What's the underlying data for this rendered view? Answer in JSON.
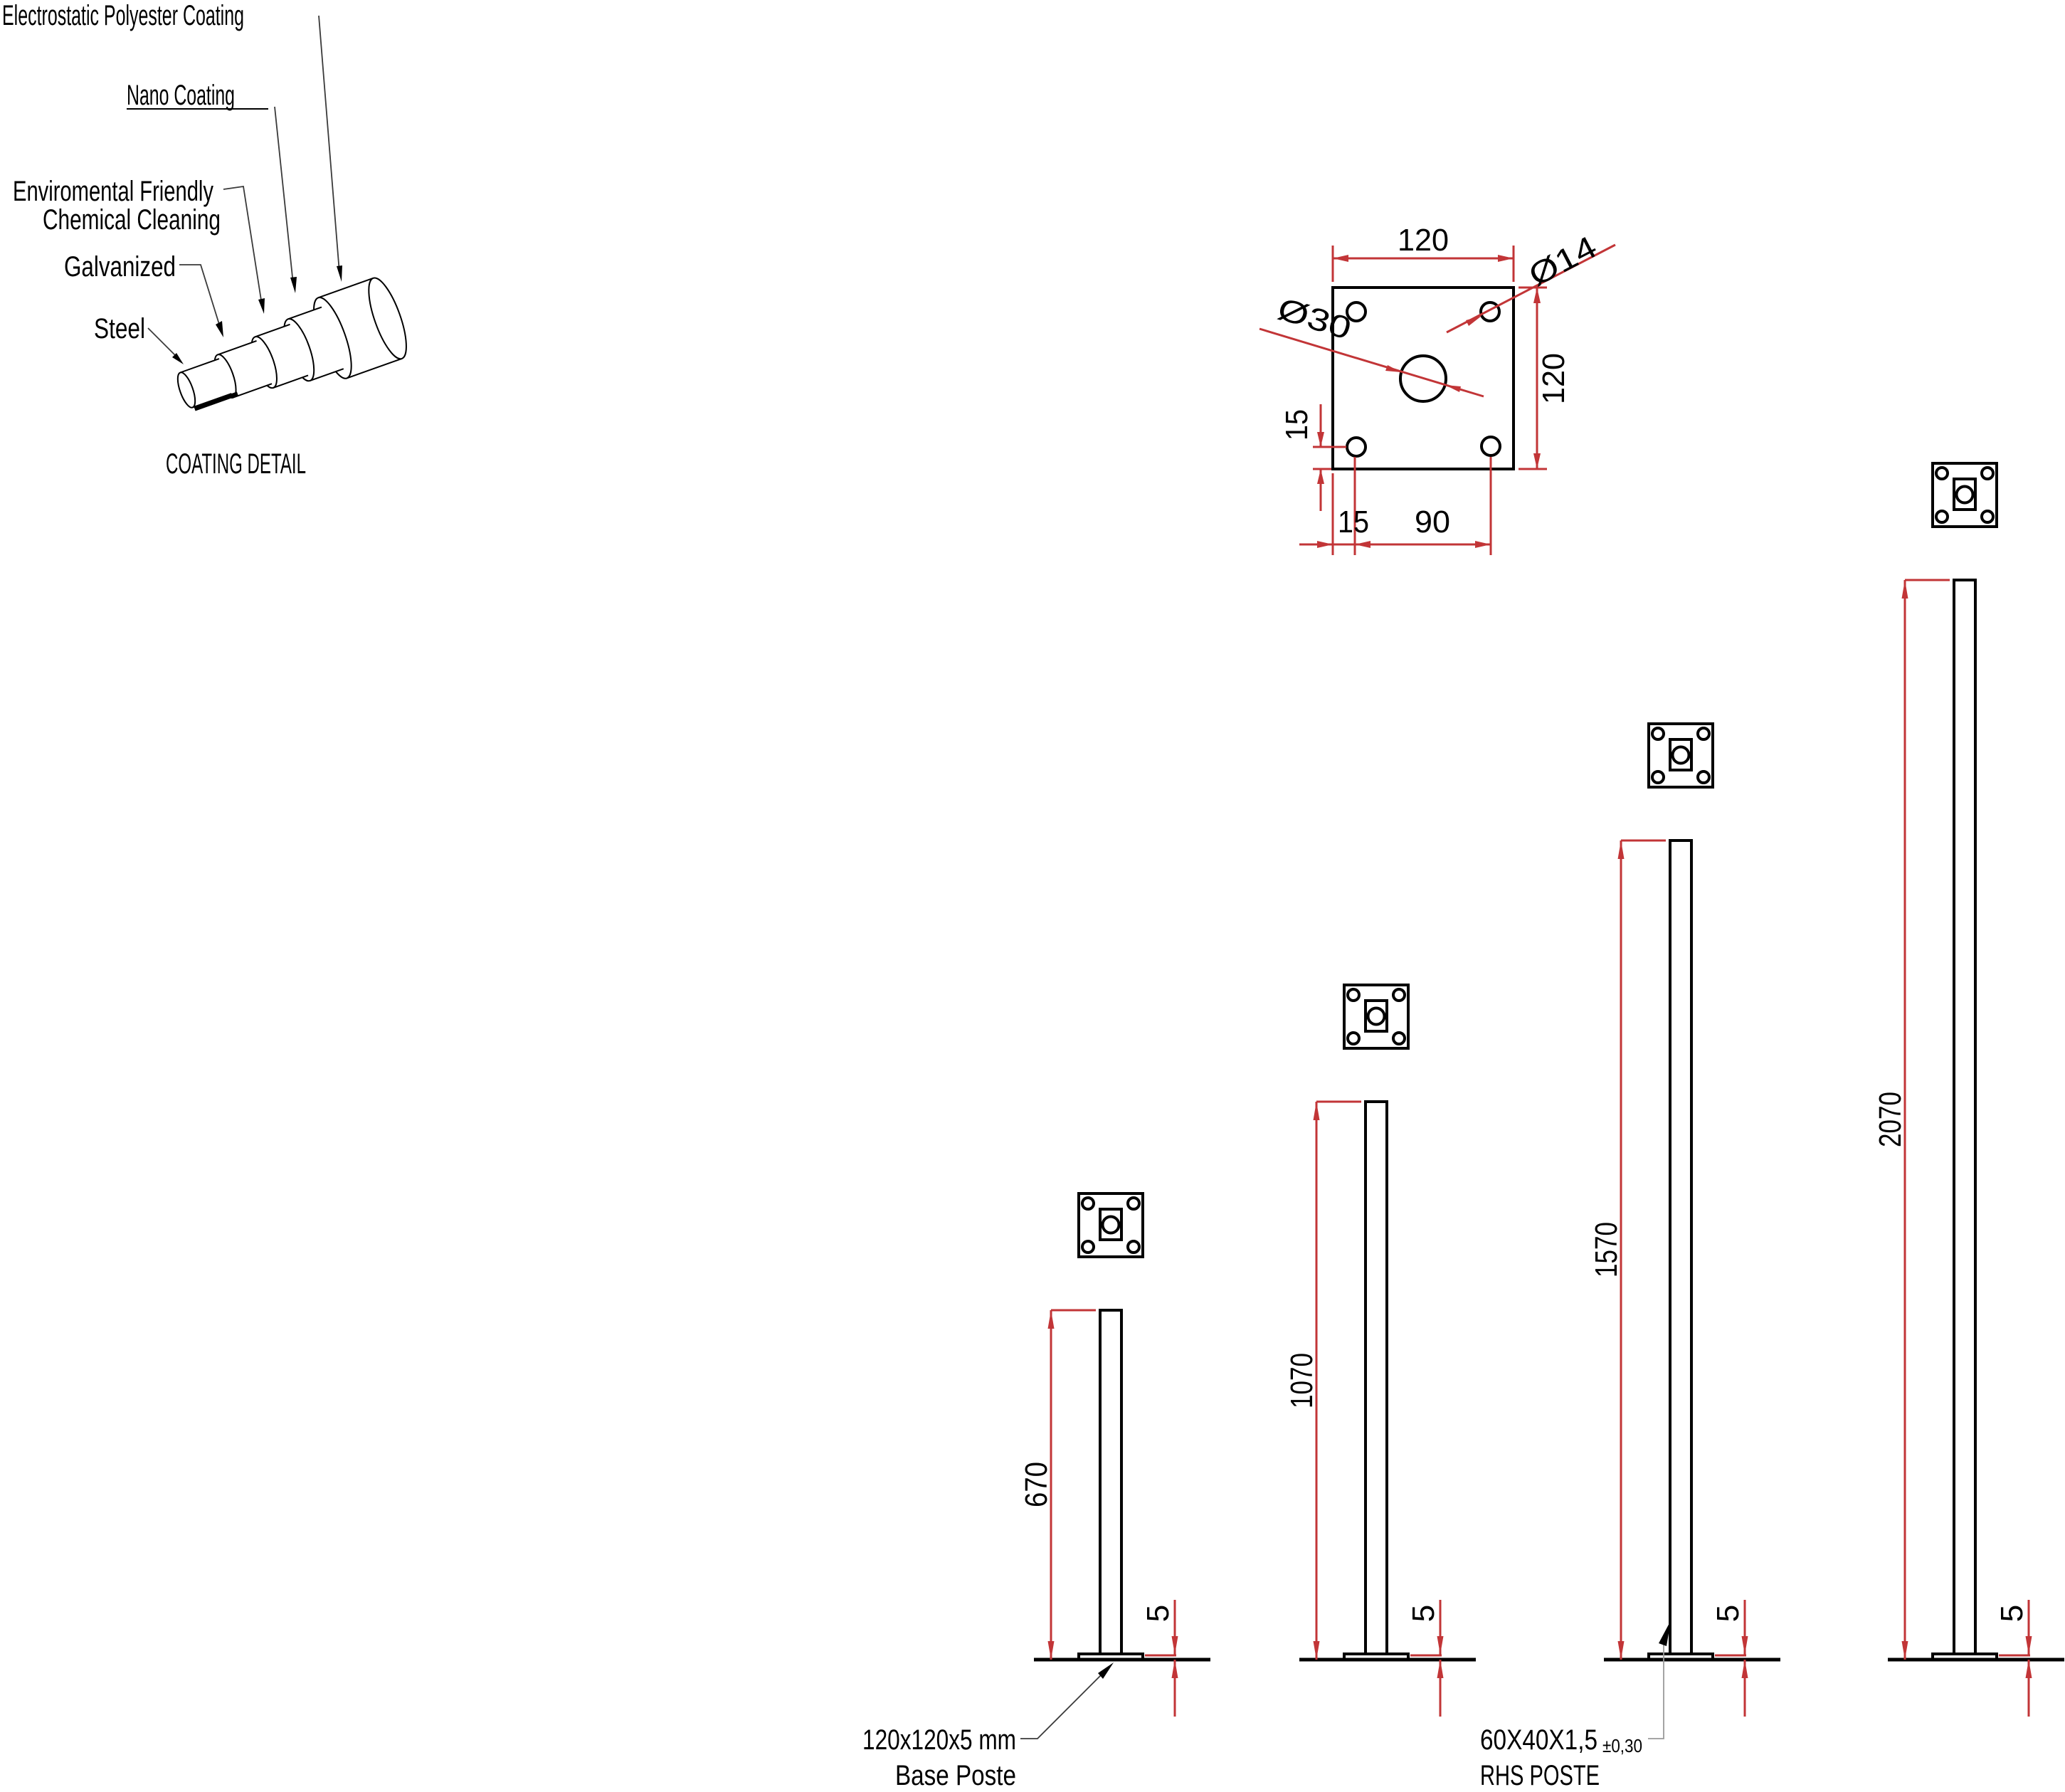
{
  "coating_detail": {
    "title": "COATING DETAIL",
    "labels": {
      "layer1": "Electrostatic Polyester Coating",
      "layer2": "Nano Coating",
      "layer3_line1": "Enviromental Friendly",
      "layer3_line2": "Chemical Cleaning",
      "layer4": "Galvanized",
      "layer5": "Steel"
    }
  },
  "base_plate_detail": {
    "dims": {
      "width": "120",
      "height": "120",
      "hole_diameter": "Ø14",
      "center_hole_diameter": "Ø30",
      "hole_offset_vertical": "15",
      "hole_offset_horizontal": "15",
      "hole_spacing": "90"
    }
  },
  "posts": [
    {
      "height": "670",
      "base_thickness": "5"
    },
    {
      "height": "1070",
      "base_thickness": "5"
    },
    {
      "height": "1570",
      "base_thickness": "5"
    },
    {
      "height": "2070",
      "base_thickness": "5"
    }
  ],
  "callouts": {
    "base_plate": {
      "line1": "120x120x5 mm",
      "line2": "Base Poste"
    },
    "rhs_post": {
      "size": "60X40X1,5",
      "tolerance": "±0,30",
      "line2": "RHS POSTE"
    }
  },
  "colors": {
    "dimension": "#c23537",
    "drawing": "#000000",
    "leader": "#9a9a9a"
  }
}
